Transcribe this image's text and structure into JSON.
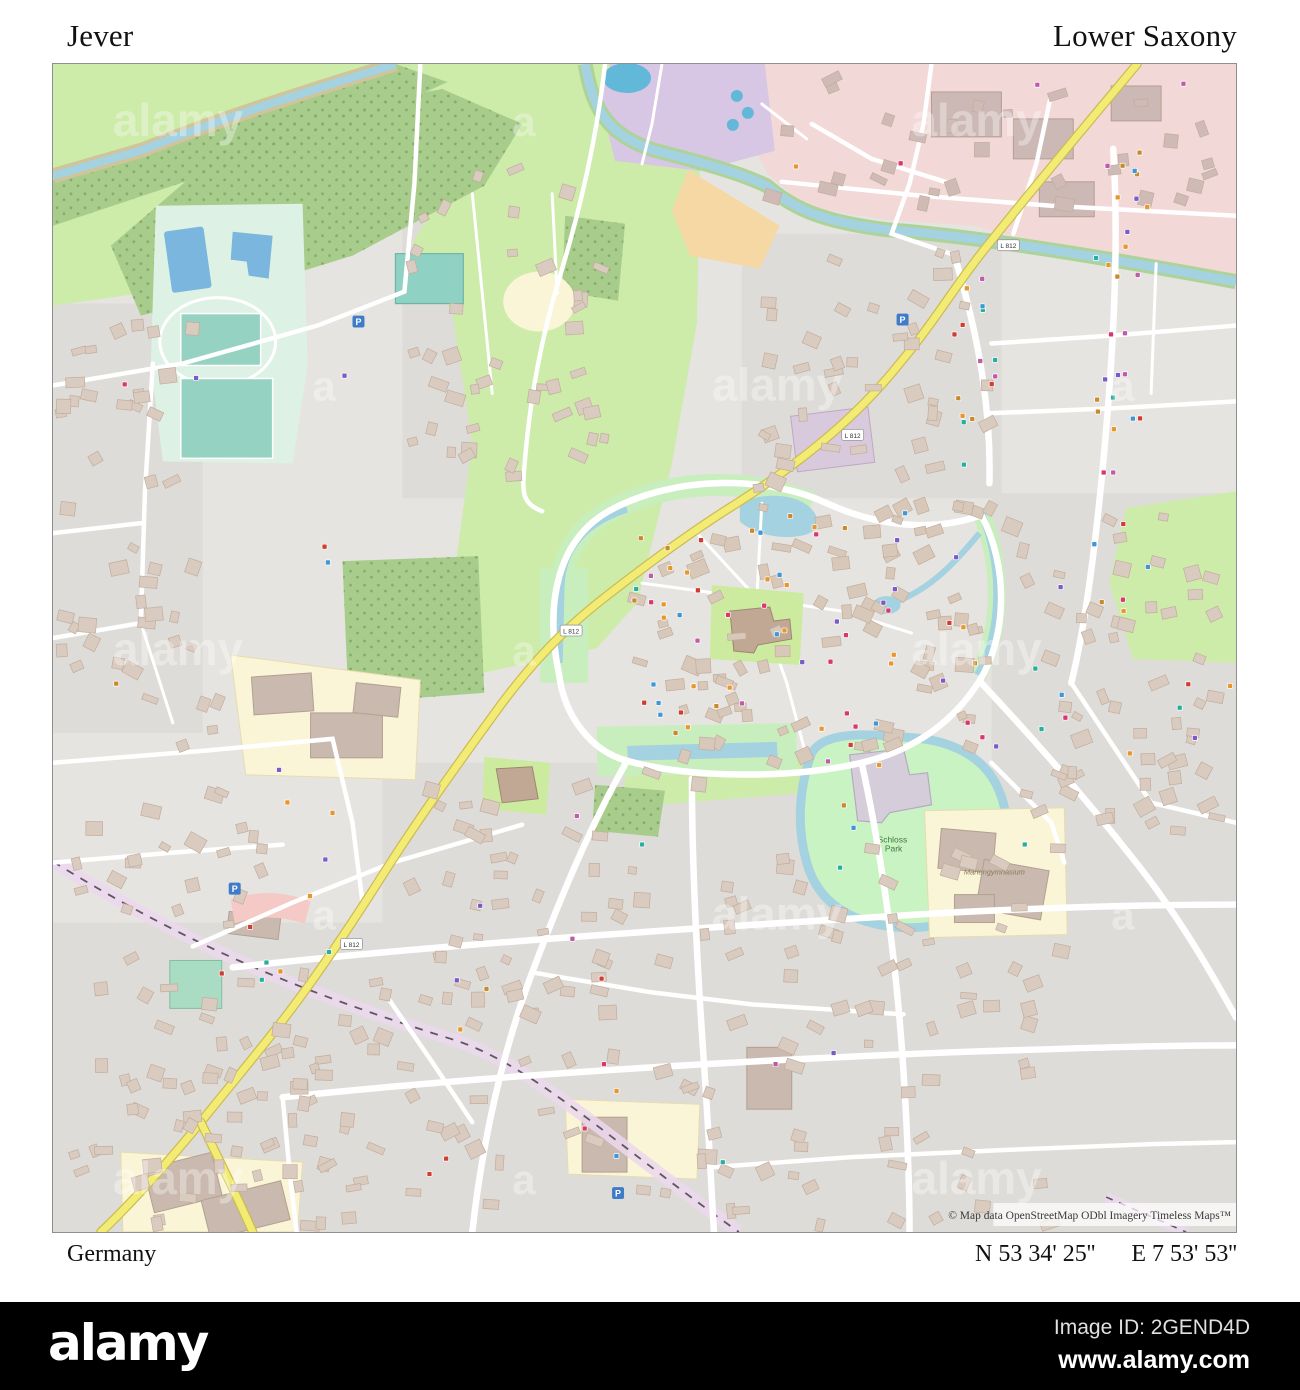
{
  "header": {
    "place": "Jever",
    "region": "Lower Saxony"
  },
  "footer": {
    "country": "Germany",
    "lat": "N 53 34' 25''",
    "lon": "E 7 53' 53''"
  },
  "map": {
    "attribution": "© Map data OpenStreetMap ODbl Imagery Timeless Maps™",
    "labels": {
      "park_line1": "Schloss",
      "park_line2": "Park",
      "school": "Mariengymnasium",
      "road_ref": "L 812",
      "parking_letter": "P"
    },
    "watermark_word": "alamy",
    "watermark_letter": "a",
    "colors": {
      "field_green": "#cdeba9",
      "forest_green": "#a8cc8b",
      "forest_dot": "#84ab67",
      "park_green": "#c9f3c2",
      "water_blue": "#a4d2e0",
      "pitch_teal": "#96d2c2",
      "pool_blue": "#7ab6dd",
      "industrial_pink": "#f2d8d7",
      "leisure_lavender": "#d7c6e4",
      "allotment_orange": "#f6d8a4",
      "school_cream": "#fbf5d7",
      "road_yellow": "#f2ec75",
      "building_tan": "#d9cbc0",
      "building_stroke": "#c2ad9c",
      "railway_dash": "#5a5a5a",
      "poi_palette": [
        "#bf5ba8",
        "#e8962e",
        "#cf3d33",
        "#3f97d3",
        "#2aaf9e",
        "#7b5cc6",
        "#d9376e",
        "#c98a2e"
      ]
    }
  },
  "branding": {
    "logo": "alamy",
    "image_id": "Image ID: 2GEND4D",
    "website": "www.alamy.com"
  }
}
